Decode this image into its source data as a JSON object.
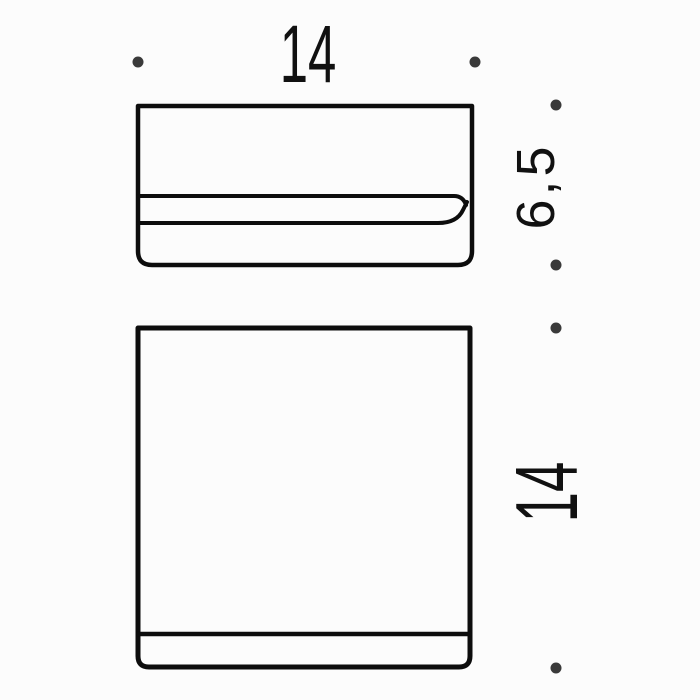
{
  "colors": {
    "bg": "#fcfcfc",
    "line": "#0d0d0d",
    "dot": "#3a3a3a",
    "text": "#111111"
  },
  "dimensions": {
    "width_label": "14",
    "side_label": "6,5",
    "height_label": "14"
  }
}
